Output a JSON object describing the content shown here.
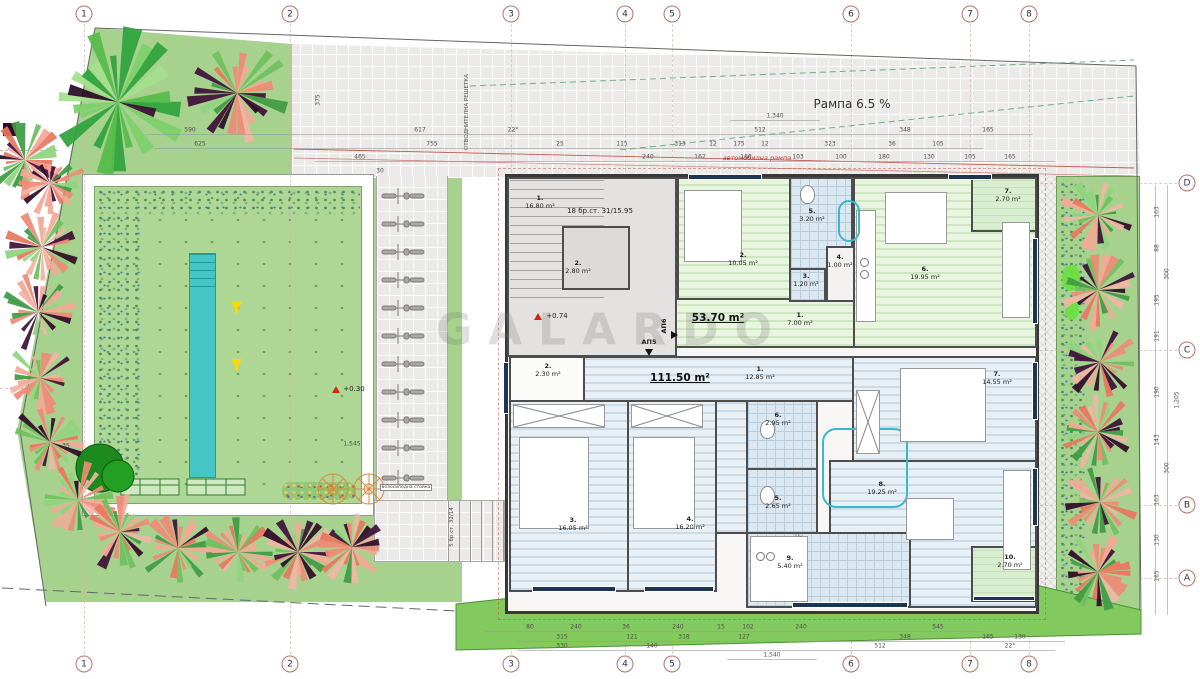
{
  "drawing": {
    "watermark": "GALARDO",
    "ramp_label": "Рампа 6.5 %",
    "ramp_red_label": "автомобилна рампа",
    "drain_label": "ОТВОДНИТЕЛНА РЕШЕТКА",
    "bike_rack_label": "велосипедна стойка",
    "stairs_main": "18 бр.ст. 31/15.95",
    "stairs_ext": "5 бр.ст. 32/14",
    "level_entry": "+0.74",
    "level_garden": "+0.30",
    "ts_label": "ТС"
  },
  "grid": {
    "columns": [
      "1",
      "2",
      "3",
      "4",
      "5",
      "6",
      "7",
      "8"
    ],
    "rows": [
      "D",
      "C",
      "B",
      "A"
    ]
  },
  "apartments": {
    "common": {
      "rooms": [
        {
          "no": "1.",
          "area": "16.80 m²"
        },
        {
          "no": "2.",
          "area": "2.80 m²"
        }
      ]
    },
    "ap6": {
      "code": "АП6",
      "total": "53.70 m²",
      "rooms": [
        {
          "no": "1.",
          "area": "7.00 m²"
        },
        {
          "no": "2.",
          "area": "10.05 m²"
        },
        {
          "no": "3.",
          "area": "1.20 m²"
        },
        {
          "no": "4.",
          "area": "1.00 m²"
        },
        {
          "no": "5.",
          "area": "3.20 m²"
        },
        {
          "no": "6.",
          "area": "19.95 m²"
        },
        {
          "no": "7.",
          "area": "2.70 m²"
        }
      ]
    },
    "ap5": {
      "code": "АП5",
      "total": "111.50 m²",
      "rooms": [
        {
          "no": "1.",
          "area": "12.85 m²"
        },
        {
          "no": "2.",
          "area": "2.30 m²"
        },
        {
          "no": "3.",
          "area": "16.05 m²"
        },
        {
          "no": "4.",
          "area": "16.20 m²"
        },
        {
          "no": "5.",
          "area": "2.65 m²"
        },
        {
          "no": "6.",
          "area": "2.95 m²"
        },
        {
          "no": "7.",
          "area": "14.55 m²"
        },
        {
          "no": "8.",
          "area": "19.25 m²"
        },
        {
          "no": "9.",
          "area": "5.40 m²"
        },
        {
          "no": "10.",
          "area": "2.70 m²"
        }
      ]
    }
  },
  "dims": {
    "top1": [
      "1,340"
    ],
    "top2": [
      "590",
      "617",
      "22°",
      "512",
      "348",
      "165"
    ],
    "top3": [
      "625",
      "755",
      "25",
      "115",
      "313",
      "12",
      "175",
      "12",
      "323",
      "36",
      "105"
    ],
    "top4": [
      "465",
      "240",
      "162",
      "160",
      "103",
      "100",
      "180",
      "130",
      "105",
      "165"
    ],
    "bottom1": [
      "80",
      "240",
      "36",
      "240",
      "15",
      "102",
      "240",
      "545"
    ],
    "bottom2": [
      "315",
      "121",
      "318",
      "127",
      "348",
      "165",
      "130"
    ],
    "bottom3": [
      "330",
      "140",
      "512",
      "22°"
    ],
    "bottom4": [
      "1,540"
    ],
    "right": [
      "103",
      "88",
      "300",
      "195",
      "191",
      "190",
      "143",
      "300",
      "103",
      "130",
      "165"
    ],
    "right_total": "1,205",
    "garden": [
      "1,545",
      "375",
      "30",
      "35"
    ]
  },
  "colors": {
    "garden_green": "#a6d28e",
    "pool_teal": "#45c6c4",
    "axis_red": "#c0392b",
    "window_navy": "#1c3550",
    "strip_green": "#82c95e"
  }
}
